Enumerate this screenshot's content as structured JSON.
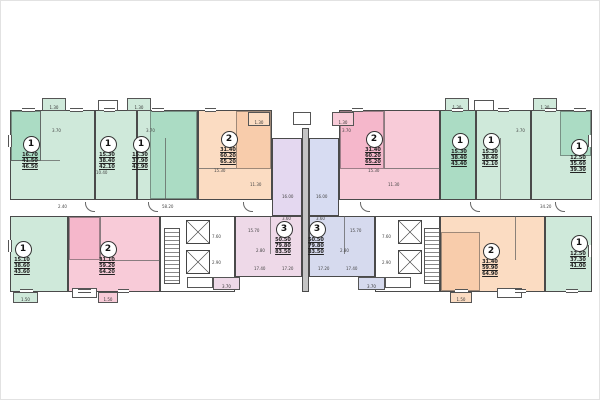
{
  "plan_type": "apartment-building-floor-plan",
  "colors": {
    "one_room_green": "#cfe9da",
    "two_room_orange": "#fbdcc2",
    "two_room_pink": "#f8cbd8",
    "three_room_lavender_left": "#eed9e8",
    "three_room_lavender_right": "#d6daee",
    "walls": "#4a4a4a"
  },
  "apartments": [
    {
      "type": "1",
      "areas": [
        "16.70",
        "41.50",
        "46.50"
      ]
    },
    {
      "type": "1",
      "areas": [
        "15.30",
        "38.40",
        "42.10"
      ]
    },
    {
      "type": "1",
      "areas": [
        "15.30",
        "37.90",
        "42.90"
      ]
    },
    {
      "type": "2",
      "areas": [
        "31.40",
        "60.20",
        "65.20"
      ]
    },
    {
      "type": "2",
      "areas": [
        "31.40",
        "60.20",
        "65.20"
      ]
    },
    {
      "type": "1",
      "areas": [
        "15.30",
        "38.40",
        "43.40"
      ]
    },
    {
      "type": "1",
      "areas": [
        "15.30",
        "38.40",
        "42.10"
      ]
    },
    {
      "type": "1",
      "areas": [
        "12.50",
        "35.60",
        "39.30"
      ]
    },
    {
      "type": "1",
      "areas": [
        "15.10",
        "38.60",
        "43.60"
      ]
    },
    {
      "type": "2",
      "areas": [
        "31.10",
        "59.20",
        "64.20"
      ]
    },
    {
      "type": "3",
      "areas": [
        "50.50",
        "79.80",
        "83.50"
      ]
    },
    {
      "type": "3",
      "areas": [
        "50.50",
        "79.80",
        "83.50"
      ]
    },
    {
      "type": "2",
      "areas": [
        "31.40",
        "59.90",
        "64.90"
      ]
    },
    {
      "type": "1",
      "areas": [
        "12.50",
        "37.30",
        "41.00"
      ]
    }
  ],
  "balconies": {
    "top": "1.30",
    "bottom": "1.50",
    "terrace": "3.70"
  },
  "dims": [
    "3.70",
    "3.70",
    "3.70",
    "3.70",
    "15.30",
    "11.30",
    "16.00",
    "16.00",
    "3.60",
    "3.60",
    "15.70",
    "15.70",
    "2.80",
    "2.80",
    "17.40",
    "17.20",
    "17.20",
    "17.40",
    "7.60",
    "7.60",
    "2.90",
    "2.90",
    "58.20",
    "34.20",
    "2.40",
    "11.30",
    "15.30",
    "10.40"
  ]
}
